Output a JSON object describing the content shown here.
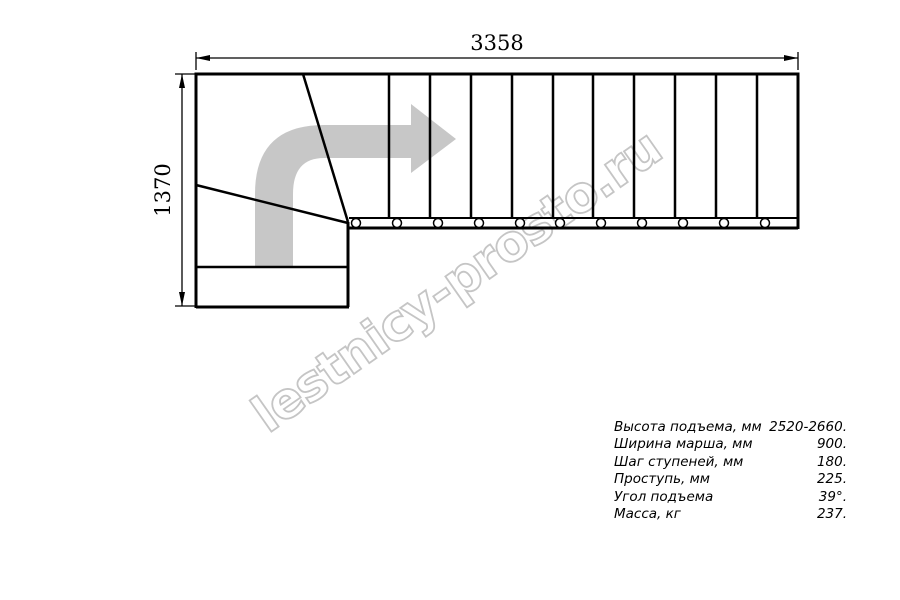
{
  "watermark": {
    "text": "lestnicy-prosto.ru",
    "color": "#c5c5c5"
  },
  "drawing": {
    "type": "staircase-plan-top-view",
    "dim_width_mm": "3358",
    "dim_height_mm": "1370",
    "line_color": "#000000",
    "arrow_color": "#c7c7c7",
    "straight_step_count": 10,
    "winder_step_count": 3,
    "baluster_circle_count": 11
  },
  "specs": {
    "rows": [
      {
        "label": "Высота подъема, мм",
        "value": "2520-2660."
      },
      {
        "label": "Ширина марша, мм",
        "value": "900."
      },
      {
        "label": "Шаг ступеней, мм",
        "value": "180."
      },
      {
        "label": "Проступь, мм",
        "value": "225."
      },
      {
        "label": "Угол подъема",
        "value": "39°."
      },
      {
        "label": "Масса, кг",
        "value": "237."
      }
    ]
  }
}
